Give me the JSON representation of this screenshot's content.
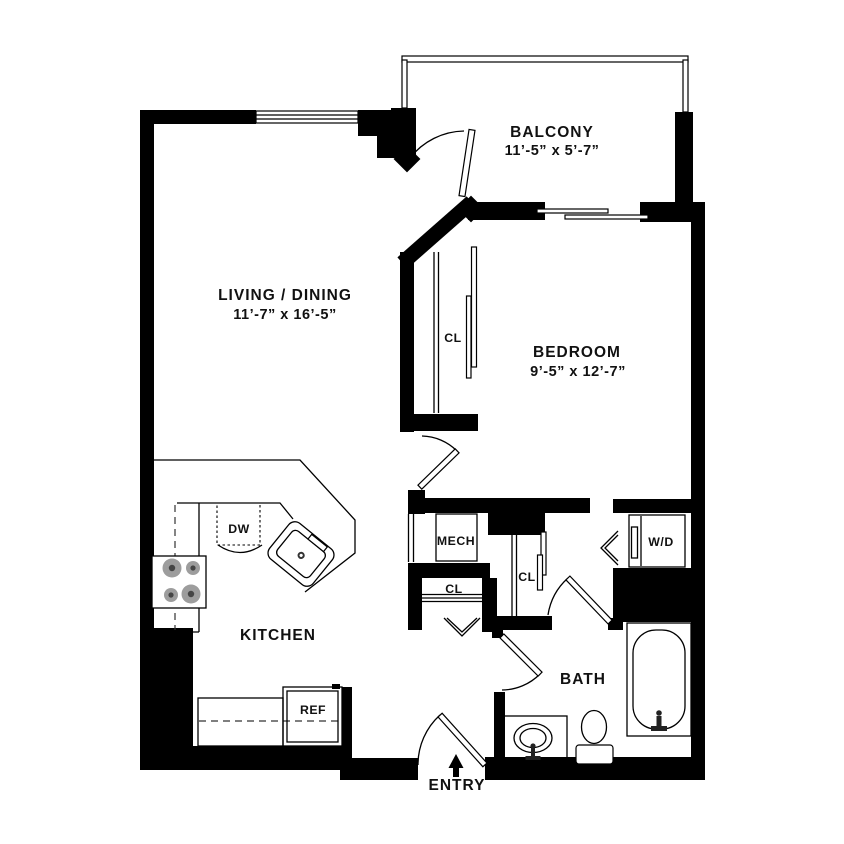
{
  "rooms": {
    "balcony": {
      "name": "BALCONY",
      "dims": "11’-5” x 5’-7”"
    },
    "living_dining": {
      "name": "LIVING / DINING",
      "dims": "11’-7” x 16’-5”"
    },
    "bedroom": {
      "name": "BEDROOM",
      "dims": "9’-5” x 12’-7”"
    },
    "kitchen": {
      "name": "KITCHEN"
    },
    "bath": {
      "name": "BATH"
    },
    "entry": {
      "name": "ENTRY"
    }
  },
  "labels": {
    "bedroom_closet": "CL",
    "linen_closet": "CL",
    "hall_closet": "CL",
    "mechanical": "MECH",
    "washer_dryer": "W/D",
    "dishwasher": "DW",
    "refrigerator": "REF"
  },
  "colors": {
    "walls": "#000000",
    "background": "#ffffff",
    "burner": "#9d9d9d",
    "burner_center": "#454545",
    "text": "#111111"
  }
}
